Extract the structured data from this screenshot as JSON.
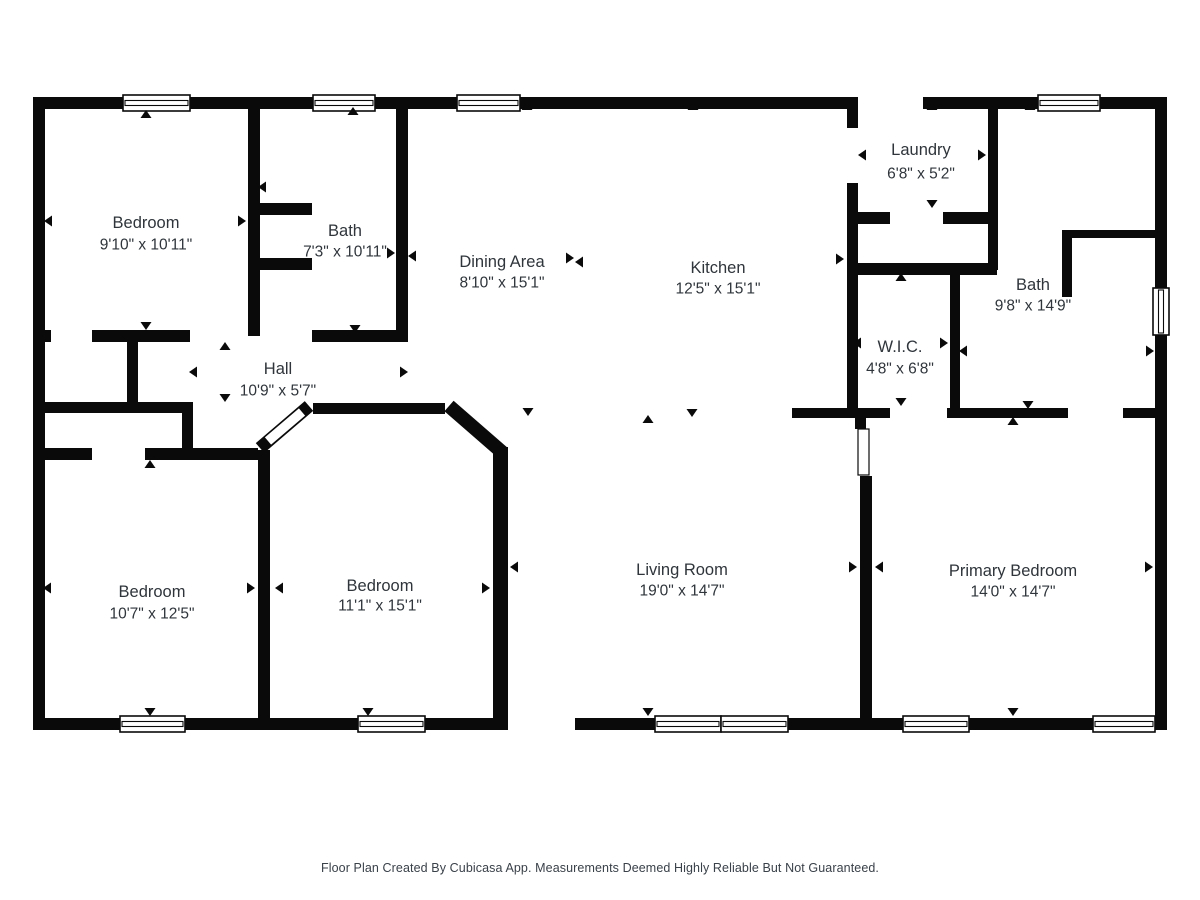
{
  "page": {
    "background": "#ffffff",
    "wall_color": "#0a0a0a",
    "text_color": "#2f353b",
    "footer_color": "#3a4149"
  },
  "footer": {
    "text": "Floor Plan Created By Cubicasa App. Measurements Deemed Highly Reliable But Not Guaranteed."
  },
  "rooms": [
    {
      "id": "bedroom-top-left",
      "name": "Bedroom",
      "dims": "9'10\" x 10'11\"",
      "x": 146,
      "name_y": 223,
      "dims_y": 245
    },
    {
      "id": "bath-top-left",
      "name": "Bath",
      "dims": "7'3\" x 10'11\"",
      "x": 345,
      "name_y": 231,
      "dims_y": 252
    },
    {
      "id": "dining-area",
      "name": "Dining Area",
      "dims": "8'10\" x 15'1\"",
      "x": 502,
      "name_y": 262,
      "dims_y": 283
    },
    {
      "id": "kitchen",
      "name": "Kitchen",
      "dims": "12'5\" x 15'1\"",
      "x": 718,
      "name_y": 268,
      "dims_y": 289
    },
    {
      "id": "laundry",
      "name": "Laundry",
      "dims": "6'8\" x 5'2\"",
      "x": 921,
      "name_y": 150,
      "dims_y": 174
    },
    {
      "id": "bath-top-right",
      "name": "Bath",
      "dims": "9'8\" x 14'9\"",
      "x": 1033,
      "name_y": 285,
      "dims_y": 306
    },
    {
      "id": "wic",
      "name": "W.I.C.",
      "dims": "4'8\" x 6'8\"",
      "x": 900,
      "name_y": 347,
      "dims_y": 369
    },
    {
      "id": "hall",
      "name": "Hall",
      "dims": "10'9\" x 5'7\"",
      "x": 278,
      "name_y": 369,
      "dims_y": 391
    },
    {
      "id": "bedroom-bottom-left",
      "name": "Bedroom",
      "dims": "10'7\" x 12'5\"",
      "x": 152,
      "name_y": 592,
      "dims_y": 614
    },
    {
      "id": "bedroom-bottom-middle",
      "name": "Bedroom",
      "dims": "11'1\" x 15'1\"",
      "x": 380,
      "name_y": 586,
      "dims_y": 606
    },
    {
      "id": "living-room",
      "name": "Living Room",
      "dims": "19'0\" x 14'7\"",
      "x": 682,
      "name_y": 570,
      "dims_y": 591
    },
    {
      "id": "primary-bedroom",
      "name": "Primary Bedroom",
      "dims": "14'0\" x 14'7\"",
      "x": 1013,
      "name_y": 571,
      "dims_y": 592
    }
  ],
  "plan": {
    "walls": [
      [
        33,
        97,
        825,
        12
      ],
      [
        923,
        97,
        244,
        12
      ],
      [
        33,
        97,
        12,
        633
      ],
      [
        1155,
        97,
        12,
        633
      ],
      [
        33,
        718,
        475,
        12
      ],
      [
        575,
        718,
        592,
        12
      ],
      [
        248,
        109,
        12,
        227
      ],
      [
        257,
        203,
        55,
        12
      ],
      [
        257,
        258,
        55,
        12
      ],
      [
        396,
        109,
        12,
        233
      ],
      [
        45,
        330,
        6,
        12
      ],
      [
        92,
        330,
        98,
        12
      ],
      [
        312,
        330,
        96,
        12
      ],
      [
        127,
        342,
        11,
        62
      ],
      [
        40,
        402,
        142,
        11
      ],
      [
        182,
        402,
        11,
        51
      ],
      [
        33,
        448,
        59,
        12
      ],
      [
        145,
        448,
        113,
        12
      ],
      [
        258,
        450,
        12,
        280
      ],
      [
        313,
        403,
        132,
        11
      ],
      [
        493,
        447,
        15,
        283
      ],
      [
        855,
        418,
        11,
        11
      ],
      [
        860,
        476,
        12,
        254
      ],
      [
        792,
        408,
        98,
        10
      ],
      [
        947,
        408,
        121,
        10
      ],
      [
        1123,
        408,
        32,
        10
      ],
      [
        847,
        97,
        11,
        31
      ],
      [
        847,
        183,
        11,
        235
      ],
      [
        858,
        263,
        139,
        12
      ],
      [
        858,
        212,
        32,
        12
      ],
      [
        943,
        212,
        45,
        12
      ],
      [
        988,
        109,
        10,
        161
      ],
      [
        950,
        275,
        10,
        133
      ],
      [
        1062,
        230,
        10,
        67
      ],
      [
        1072,
        230,
        83,
        8
      ]
    ],
    "diagonal_walls": [
      {
        "x1": 449,
        "y1": 406,
        "x2": 503,
        "y2": 453,
        "w": 14
      },
      {
        "x1": 260,
        "y1": 448,
        "x2": 309,
        "y2": 406,
        "w": 13
      }
    ],
    "diagonal_door_overlays": [
      {
        "x1": 268,
        "y1": 441,
        "x2": 302,
        "y2": 412,
        "w": 9.5
      }
    ],
    "windows": [
      [
        123,
        95,
        67,
        16
      ],
      [
        313,
        95,
        62,
        16
      ],
      [
        457,
        95,
        63,
        16
      ],
      [
        1038,
        95,
        62,
        16
      ],
      [
        120,
        716,
        65,
        16
      ],
      [
        358,
        716,
        67,
        16
      ],
      [
        655,
        716,
        66,
        16
      ],
      [
        721,
        716,
        67,
        16
      ],
      [
        903,
        716,
        66,
        16
      ],
      [
        1093,
        716,
        62,
        16
      ],
      [
        1153,
        288,
        16,
        47
      ]
    ],
    "door_openings": [
      [
        858,
        429,
        11,
        46
      ]
    ],
    "arrows": [
      [
        146,
        114,
        "up"
      ],
      [
        48,
        221,
        "left"
      ],
      [
        242,
        221,
        "right"
      ],
      [
        146,
        326,
        "down"
      ],
      [
        353,
        111,
        "up"
      ],
      [
        262,
        187,
        "left"
      ],
      [
        391,
        253,
        "right"
      ],
      [
        355,
        329,
        "down"
      ],
      [
        527,
        106,
        "up"
      ],
      [
        412,
        256,
        "left"
      ],
      [
        570,
        258,
        "right"
      ],
      [
        528,
        412,
        "down"
      ],
      [
        693,
        106,
        "up"
      ],
      [
        579,
        262,
        "left"
      ],
      [
        840,
        259,
        "right"
      ],
      [
        692,
        413,
        "down"
      ],
      [
        932,
        106,
        "up"
      ],
      [
        862,
        155,
        "left"
      ],
      [
        982,
        155,
        "right"
      ],
      [
        932,
        204,
        "down"
      ],
      [
        1030,
        106,
        "up"
      ],
      [
        963,
        351,
        "left"
      ],
      [
        1150,
        351,
        "right"
      ],
      [
        1028,
        405,
        "down"
      ],
      [
        901,
        277,
        "up"
      ],
      [
        857,
        343,
        "left"
      ],
      [
        944,
        343,
        "right"
      ],
      [
        901,
        402,
        "down"
      ],
      [
        225,
        346,
        "up"
      ],
      [
        193,
        372,
        "left"
      ],
      [
        404,
        372,
        "right"
      ],
      [
        225,
        398,
        "down"
      ],
      [
        150,
        464,
        "up"
      ],
      [
        47,
        588,
        "left"
      ],
      [
        251,
        588,
        "right"
      ],
      [
        150,
        712,
        "down"
      ],
      [
        326,
        409,
        "up"
      ],
      [
        279,
        588,
        "left"
      ],
      [
        486,
        588,
        "right"
      ],
      [
        368,
        712,
        "down"
      ],
      [
        648,
        419,
        "up"
      ],
      [
        514,
        567,
        "left"
      ],
      [
        853,
        567,
        "right"
      ],
      [
        648,
        712,
        "down"
      ],
      [
        1013,
        421,
        "up"
      ],
      [
        879,
        567,
        "left"
      ],
      [
        1149,
        567,
        "right"
      ],
      [
        1013,
        712,
        "down"
      ]
    ]
  }
}
